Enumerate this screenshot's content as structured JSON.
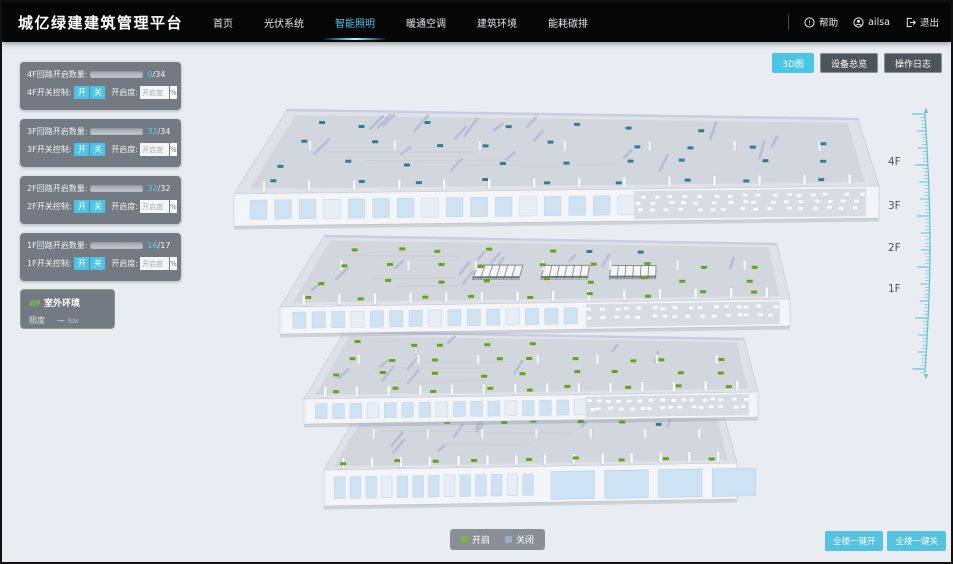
{
  "header": {
    "title": "城亿绿建建筑管理平台",
    "nav_items": [
      {
        "label": "首页"
      },
      {
        "label": "光伏系统"
      },
      {
        "label": "智能照明"
      },
      {
        "label": "暖通空调"
      },
      {
        "label": "建筑环境"
      },
      {
        "label": "能耗碳排"
      }
    ],
    "help_label": "帮助",
    "username": "ailsa",
    "logout_label": "退出"
  },
  "toolbar": {
    "view_3d": "3D图",
    "device_overview": "设备总览",
    "operation_log": "操作日志"
  },
  "floor_panels": [
    {
      "floor": "4F",
      "count_label": "4F回路开启数量:",
      "on": 0,
      "total": 34,
      "count_text": "0",
      "count_total_text": "/34",
      "switch_label": "4F开关控制:",
      "btn_on": "开",
      "btn_off": "关",
      "openness_label": "开启度:",
      "openness_placeholder": "开启度",
      "percent": "%"
    },
    {
      "floor": "3F",
      "count_label": "3F回路开启数量:",
      "on": 32,
      "total": 34,
      "count_text": "32",
      "count_total_text": "/34",
      "switch_label": "3F开关控制:",
      "btn_on": "开",
      "btn_off": "关",
      "openness_label": "开启度:",
      "openness_placeholder": "开启度",
      "percent": "%"
    },
    {
      "floor": "2F",
      "count_label": "2F回路开启数量:",
      "on": 32,
      "total": 32,
      "count_text": "32",
      "count_total_text": "/32",
      "switch_label": "2F开关控制:",
      "btn_on": "开",
      "btn_off": "关",
      "openness_label": "开启度:",
      "openness_placeholder": "开启度",
      "percent": "%"
    },
    {
      "floor": "1F",
      "count_label": "1F回路开启数量:",
      "on": 16,
      "total": 17,
      "count_text": "16",
      "count_total_text": "/17",
      "switch_label": "1F开关控制:",
      "btn_on": "开",
      "btn_off": "关",
      "openness_label": "开启度:",
      "openness_placeholder": "开启度",
      "percent": "%"
    }
  ],
  "outdoor": {
    "title": "室外环境",
    "illuminance_label": "照度",
    "illuminance_value": "—",
    "illuminance_unit": "lux"
  },
  "floor_axis": [
    "4F",
    "3F",
    "2F",
    "1F"
  ],
  "legend": {
    "on_label": "开启",
    "off_label": "关闭"
  },
  "bulk": {
    "all_on": "全楼一键开",
    "all_off": "全楼一键关"
  },
  "colors": {
    "accent": "#4cc4e6",
    "light_on": "#63a516",
    "light_off": "#2e7e99",
    "legend_on": "#7cb342",
    "legend_off": "#93aec9",
    "ruler": "#57bcd9"
  }
}
